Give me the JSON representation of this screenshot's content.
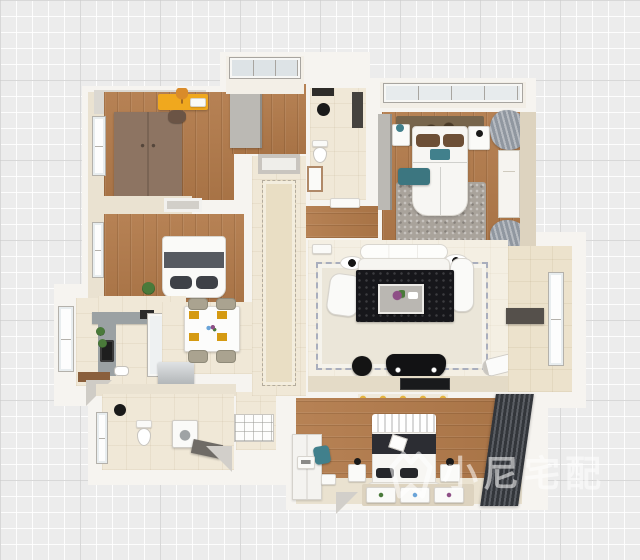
{
  "watermark": {
    "text": "小尼宅配"
  },
  "palette": {
    "grid_bg": "#ececec",
    "grid_line": "rgba(255,255,255,0.9)",
    "grid_major": "rgba(206,206,206,0.8)",
    "wall": "#f6f4f0",
    "wallpaper": "#eae2d1",
    "wood": "#b27a4a",
    "wood_deep": "#a06a3e",
    "tile": "#f0e8d7",
    "tile_warm": "#ece2cc",
    "counter": "#9ba1a3",
    "wardrobe_brown": "#8d7462",
    "closet_gray": "#bbb9b4",
    "desk_yellow": "#f0a81e",
    "navy": "#23242a",
    "black": "#17171b",
    "teal": "#41808c",
    "gray_rug": "#a9a39b",
    "rug_beige": "#ebe6d9",
    "runner": "#e9dec4",
    "curtain": "#9097a0",
    "blinds_dark": "#33363b",
    "blinds_light": "#5a5d63",
    "mosaic_yellow": "#e4b33e",
    "fridge": "#b9bdbf",
    "plant_green": "#4a7a3a",
    "flower_purple": "#8e4f86",
    "watermark": "rgba(255,255,255,0.55)"
  }
}
